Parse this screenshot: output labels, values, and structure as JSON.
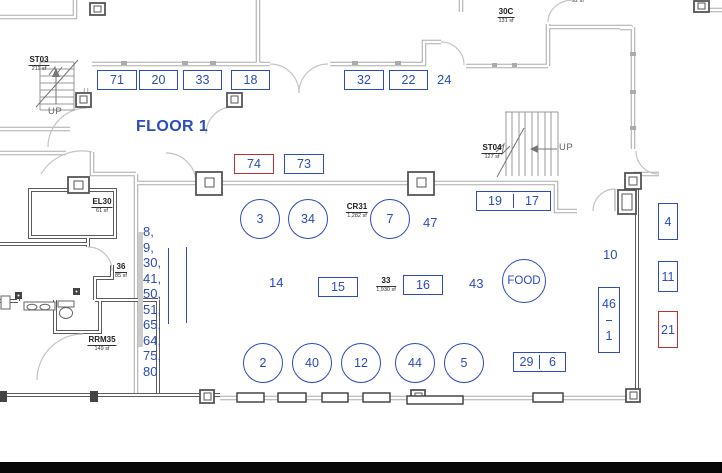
{
  "page": {
    "floor_title": "FLOOR 1"
  },
  "colors": {
    "booth_blue": "#2B4BC0",
    "booth_red": "#C13030",
    "wall_gray": "#ABABAB",
    "wall_dark": "#5B5B5B"
  },
  "booths": [
    {
      "label": "71"
    },
    {
      "label": "20"
    },
    {
      "label": "33"
    },
    {
      "label": "18"
    },
    {
      "label": "32"
    },
    {
      "label": "22"
    },
    {
      "label": "74"
    },
    {
      "label": "73"
    },
    {
      "label": "19"
    },
    {
      "label": "17"
    },
    {
      "label": "15"
    },
    {
      "label": "16"
    },
    {
      "label": "29"
    },
    {
      "label": "6"
    },
    {
      "label": "46"
    },
    {
      "label": "1"
    },
    {
      "label": "4"
    },
    {
      "label": "11"
    },
    {
      "label": "21"
    }
  ],
  "circles": [
    {
      "label": "3"
    },
    {
      "label": "34"
    },
    {
      "label": "7"
    },
    {
      "label": "2"
    },
    {
      "label": "40"
    },
    {
      "label": "12"
    },
    {
      "label": "44"
    },
    {
      "label": "5"
    },
    {
      "label": "FOOD"
    }
  ],
  "markers": [
    {
      "label": "24"
    },
    {
      "label": "47"
    },
    {
      "label": "14"
    },
    {
      "label": "43"
    },
    {
      "label": "10"
    }
  ],
  "exhibitor_list": {
    "items": [
      "8,",
      "9,",
      "30,",
      "41,",
      "50,",
      "51,",
      "65,",
      "64,",
      "75,",
      "80"
    ]
  },
  "rooms": [
    {
      "name": "ST03",
      "area": "211 sf"
    },
    {
      "name": "EL30",
      "area": "61 sf"
    },
    {
      "name": "36",
      "area": "85 sf"
    },
    {
      "name": "RRM35",
      "area": "149 sf"
    },
    {
      "name": "30C",
      "area": "131 sf"
    },
    {
      "name": "ST04",
      "area": "127 sf"
    },
    {
      "name": "CR31",
      "area": "1,282 sf"
    },
    {
      "name": "33",
      "area": "1,930 sf"
    },
    {
      "name": "",
      "area": "92 sf"
    }
  ],
  "stairs": {
    "st03_up": "UP",
    "st04_up": "UP"
  }
}
